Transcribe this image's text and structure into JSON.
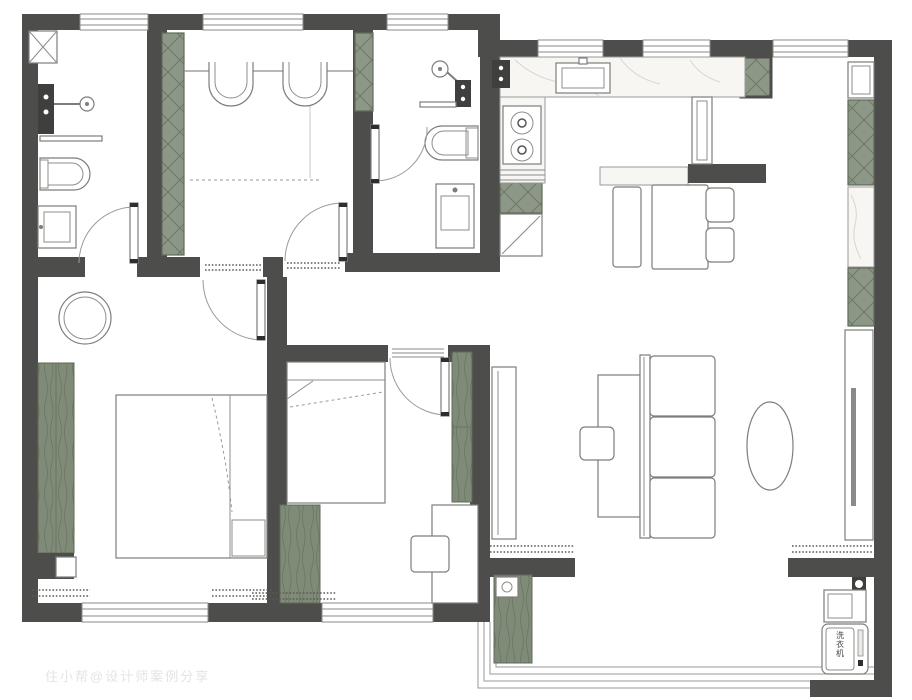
{
  "meta": {
    "type": "apartment-floor-plan",
    "canvas_width": 912,
    "canvas_height": 700
  },
  "watermark": {
    "text": "住小帮@设计师案例分享",
    "color": "#e4e4e4"
  },
  "labels": {
    "washing_machine": "洗衣机"
  },
  "colors": {
    "background": "#ffffff",
    "wall": "#4d4d4b",
    "cabinet_green": "#8d9787",
    "cabinet_green_line": "#6d7865",
    "wood_green": "#7f8b78",
    "marble": "#f7f6f3",
    "marble_vein": "#d9d6d1",
    "furniture_line": "#7d7d7b",
    "window_line": "#8a8a88"
  },
  "semantics": {
    "rooms": [
      "bathroom-1",
      "study",
      "bathroom-2",
      "kitchen",
      "dining-area",
      "living-room",
      "bedroom-1",
      "bedroom-2",
      "balcony",
      "hallway"
    ],
    "fixtures": [
      "toilet",
      "sink",
      "shower-head",
      "shower-mixer",
      "towel-bar",
      "gas-stove",
      "kitchen-sink",
      "dining-table",
      "bench",
      "chair",
      "sofa",
      "coffee-table",
      "tv-cabinet",
      "bed",
      "wardrobe",
      "desk",
      "washing-machine",
      "planter",
      "floor-drain",
      "round-side-table"
    ]
  }
}
